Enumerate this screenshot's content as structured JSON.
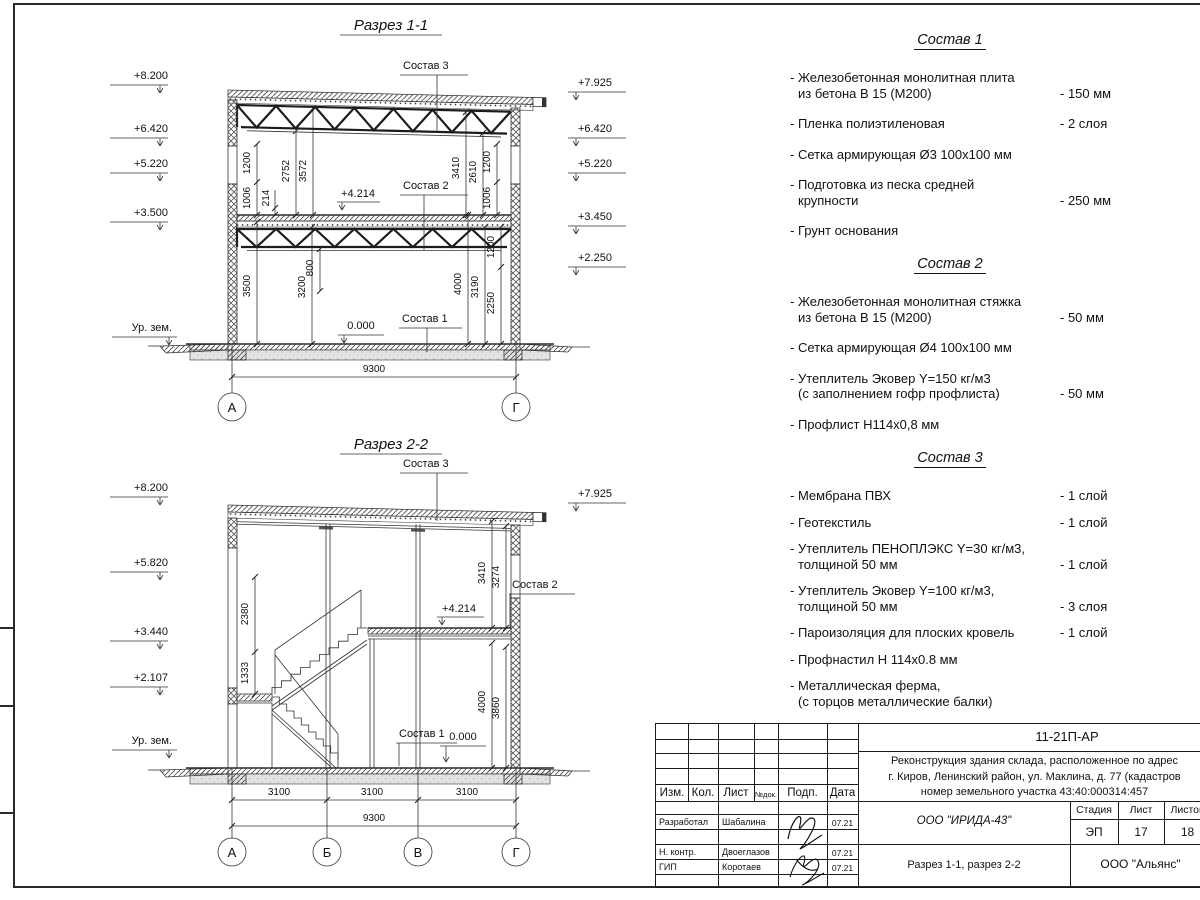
{
  "razrez1": {
    "title": "Разрез 1-1",
    "marks_left": [
      "+8.200",
      "+6.420",
      "+5.220",
      "+3.500"
    ],
    "ground_left": "Ур. зем.",
    "marks_right": [
      "+7.925",
      "+6.420",
      "+5.220",
      "+3.450",
      "+2.250"
    ],
    "leaders": {
      "s3": "Состав 3",
      "s2": "Состав 2",
      "s1": "Состав 1",
      "mid": "+4.214",
      "zero": "0.000"
    },
    "dims_ul": [
      "1200",
      "1006",
      "214",
      "2752",
      "3572"
    ],
    "dims_ur": [
      "3410",
      "2610",
      "1200",
      "1006"
    ],
    "dims_ll": [
      "3500",
      "3200",
      "800"
    ],
    "dims_lr": [
      "4000",
      "3190",
      "1200",
      "2250"
    ],
    "dim_total": "9300",
    "axes": [
      "А",
      "Г"
    ]
  },
  "razrez2": {
    "title": "Разрез 2-2",
    "marks_left": [
      "+8.200",
      "+5.820",
      "+3.440",
      "+2.107"
    ],
    "ground_left": "Ур. зем.",
    "marks_right": [
      "+7.925"
    ],
    "leaders": {
      "s3": "Состав 3",
      "s2": "Состав 2",
      "s1": "Состав 1",
      "mid": "+4.214",
      "zero": "0.000"
    },
    "dims_left": [
      "2380",
      "1333"
    ],
    "dims_ru": [
      "3410",
      "3274"
    ],
    "dims_rl": [
      "4000",
      "3860"
    ],
    "dims_bottom": [
      "3100",
      "3100",
      "3100"
    ],
    "dim_total": "9300",
    "axes": [
      "А",
      "Б",
      "В",
      "Г"
    ]
  },
  "sostav1": {
    "title": "Состав 1",
    "items": [
      {
        "name": "- Железобетонная  монолитная плита\nиз бетона В 15 (М200)",
        "value": "- 150 мм"
      },
      {
        "name": "- Пленка полиэтиленовая",
        "value": "-  2 слоя"
      },
      {
        "name": "- Сетка армирующая Ø3 100х100 мм",
        "value": ""
      },
      {
        "name": "- Подготовка из песка средней\nкрупности",
        "value": "- 250 мм"
      },
      {
        "name": "- Грунт основания",
        "value": ""
      }
    ]
  },
  "sostav2": {
    "title": "Состав 2",
    "items": [
      {
        "name": "- Железобетонная  монолитная стяжка\nиз бетона В 15 (М200)",
        "value": "- 50 мм"
      },
      {
        "name": "- Сетка армирующая Ø4 100х100 мм",
        "value": ""
      },
      {
        "name": "- Утеплитель Эковер Y=150 кг/м3\n(с заполнением гофр профлиста)",
        "value": "- 50 мм"
      },
      {
        "name": "- Профлист Н114х0,8 мм",
        "value": ""
      }
    ]
  },
  "sostav3": {
    "title": "Состав 3",
    "items": [
      {
        "name": "- Мембрана ПВХ",
        "value": "- 1 слой"
      },
      {
        "name": "- Геотекстиль",
        "value": "- 1 слой"
      },
      {
        "name": "- Утеплитель ПЕНОПЛЭКС Y=30 кг/м3,\nтолщиной 50 мм",
        "value": "- 1 слой"
      },
      {
        "name": "- Утеплитель Эковер Y=100 кг/м3,\nтолщиной 50 мм",
        "value": "- 3 слоя"
      },
      {
        "name": "- Пароизоляция для плоских кровель",
        "value": "- 1 слой"
      },
      {
        "name": "- Профнастил Н 114х0.8 мм",
        "value": ""
      },
      {
        "name": "- Металлическая ферма,\n(с торцов металлические балки)",
        "value": ""
      }
    ]
  },
  "stamp": {
    "doc_code": "11-21П-АР",
    "project": "Реконструкция здания склада, расположенное по адрес\nг. Киров, Ленинский район, ул. Маклина, д. 77 (кадастров\nномер земельного участка 43:40:000314:457",
    "rev_headers": [
      "Изм.",
      "Кол.",
      "Лист",
      "№док.",
      "Подп.",
      "Дата"
    ],
    "rows": [
      {
        "role": "Разработал",
        "name": "Шабалина",
        "date": "07.21"
      },
      {
        "role": "Н. контр.",
        "name": "Двоеглазов",
        "date": "07.21"
      },
      {
        "role": "ГИП",
        "name": "Коротаев",
        "date": "07.21"
      }
    ],
    "org": "ООО \"ИРИДА-43\"",
    "stage_label": "Стадия",
    "sheet_label": "Лист",
    "sheets_label": "Листов",
    "stage": "ЭП",
    "sheet_no": "17",
    "sheets_total": "18",
    "sheet_title": "Разрез 1-1, разрез 2-2",
    "firm": "ООО \"Альянс\""
  }
}
